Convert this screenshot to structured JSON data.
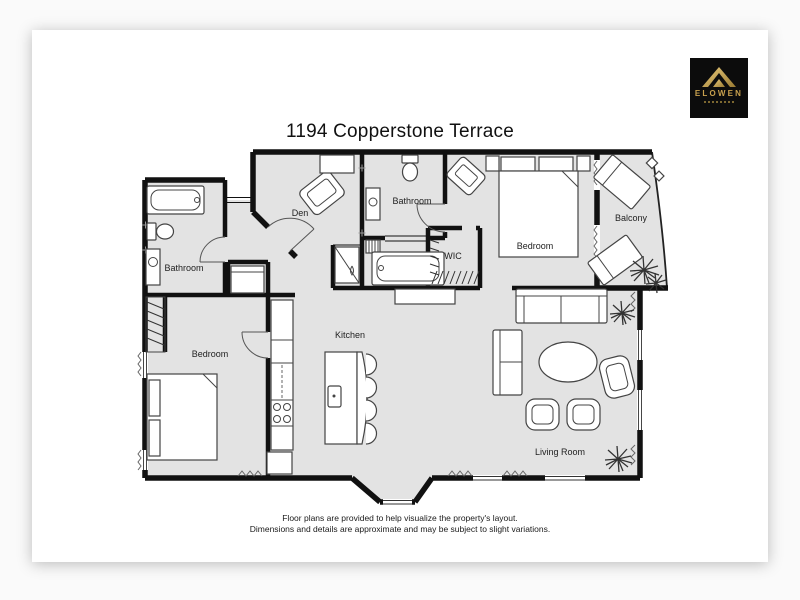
{
  "page": {
    "title": "1194 Copperstone Terrace",
    "disclaimer_line1": "Floor plans are provided to help visualize the property's layout.",
    "disclaimer_line2": "Dimensions and details are approximate and may be subject to slight variations."
  },
  "logo": {
    "brand": "ELOWEN",
    "background": "#0c0c0c",
    "gold": "#c9a14e"
  },
  "floor_plan": {
    "colors": {
      "wall": "#111111",
      "floor": "#e3e3e3",
      "furniture_outline": "#444444"
    },
    "rooms": {
      "den": {
        "label": "Den"
      },
      "bathroom_upper": {
        "label": "Bathroom"
      },
      "bathroom_left": {
        "label": "Bathroom"
      },
      "wic": {
        "label": "WIC"
      },
      "bedroom_upper": {
        "label": "Bedroom"
      },
      "balcony": {
        "label": "Balcony"
      },
      "bedroom_lower": {
        "label": "Bedroom"
      },
      "kitchen": {
        "label": "Kitchen"
      },
      "living_room": {
        "label": "Living Room"
      }
    }
  }
}
